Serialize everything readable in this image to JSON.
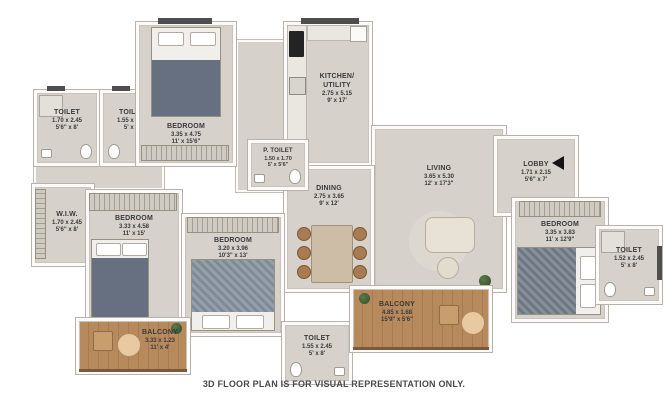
{
  "plan": {
    "footer": "3D FLOOR PLAN IS FOR VISUAL REPRESENTATION ONLY."
  },
  "colors": {
    "floor": "#d6d2cb",
    "wall": "#ffffff",
    "outline": "#b7b3ab",
    "balcony_wood": "#b78a5e",
    "label_text": "#3a3a3a",
    "entry_arrow": "#141414",
    "plant_green": "#3e5e35"
  },
  "icons": {
    "entry_arrow": "left-pointing-solid-triangle",
    "plant": "round-potted-plant"
  },
  "rooms": [
    {
      "name": "TOILET",
      "m": "1.70 x 2.45",
      "ft": "5'6\" x 8'"
    },
    {
      "name": "TOILET",
      "m": "1.55 x 2.45",
      "ft": "5' x 8'"
    },
    {
      "name": "BEDROOM",
      "m": "3.35 x 4.75",
      "ft": "11' x 15'6\""
    },
    {
      "name": "KITCHEN/ UTILITY",
      "m": "2.75 x 5.15",
      "ft": "9' x 17'"
    },
    {
      "name": "P. TOILET",
      "m": "1.50 x 1.70",
      "ft": "5' x 5'6\""
    },
    {
      "name": "LIVING",
      "m": "3.65 x 5.30",
      "ft": "12' x 17'3\""
    },
    {
      "name": "LOBBY",
      "m": "1.71 x 2.15",
      "ft": "5'6\" x 7'"
    },
    {
      "name": "DINING",
      "m": "2.75 x 3.65",
      "ft": "9' x 12'"
    },
    {
      "name": "W.I.W.",
      "m": "1.70 x 2.45",
      "ft": "5'6\" x 8'"
    },
    {
      "name": "BEDROOM",
      "m": "3.33 x 4.58",
      "ft": "11' x 15'"
    },
    {
      "name": "BEDROOM",
      "m": "3.20 x 3.96",
      "ft": "10'3\" x 13'"
    },
    {
      "name": "BEDROOM",
      "m": "3.35 x 3.83",
      "ft": "11' x 12'9\""
    },
    {
      "name": "TOILET",
      "m": "1.52 x 2.45",
      "ft": "5' x 8'"
    },
    {
      "name": "BALCONY",
      "m": "3.33 x 1.23",
      "ft": "11' x 4'"
    },
    {
      "name": "TOILET",
      "m": "1.55 x 2.45",
      "ft": "5' x 8'"
    },
    {
      "name": "BALCONY",
      "m": "4.85 x 1.68",
      "ft": "15'9\" x 5'6\""
    }
  ]
}
